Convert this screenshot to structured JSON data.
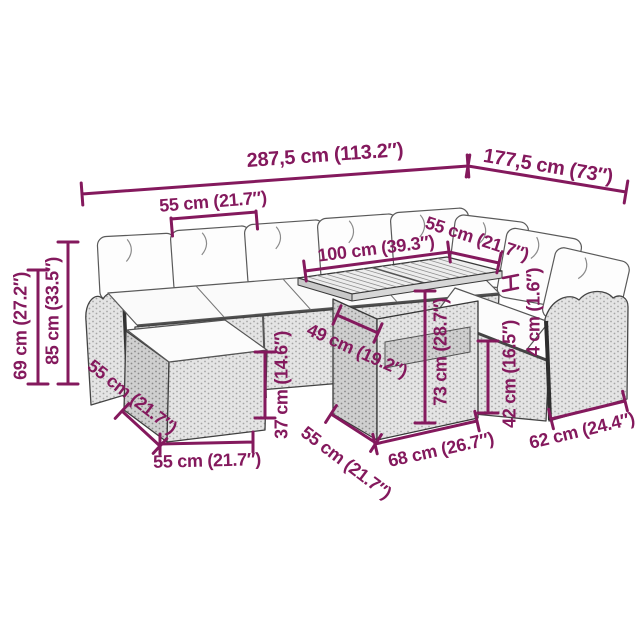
{
  "diagram": {
    "type": "product-dimension-diagram",
    "accent_color": "#84195d",
    "dimensions": [
      {
        "id": "total-width",
        "label": "287,5 cm (113.2″)"
      },
      {
        "id": "right-section-width",
        "label": "177,5 cm (73″)"
      },
      {
        "id": "seat-module-width",
        "label": "55 cm (21.7″)"
      },
      {
        "id": "backrest-height",
        "label": "69 cm (27.2″)"
      },
      {
        "id": "total-height",
        "label": "85 cm (33.5″)"
      },
      {
        "id": "footstool-depth",
        "label": "55 cm (21.7″)"
      },
      {
        "id": "footstool-width",
        "label": "55 cm (21.7″)"
      },
      {
        "id": "footstool-height",
        "label": "37 cm (14.6″)"
      },
      {
        "id": "tabletop-depth",
        "label": "49 cm (19.2″)"
      },
      {
        "id": "tabletop-width",
        "label": "100 cm (39.3″)"
      },
      {
        "id": "right-seat-width",
        "label": "55 cm (21.7″)"
      },
      {
        "id": "cushion-thickness",
        "label": "4 cm (1.6″)"
      },
      {
        "id": "table-height",
        "label": "73 cm (28.7″)"
      },
      {
        "id": "seat-height",
        "label": "42 cm (16.5″)"
      },
      {
        "id": "table-base-width",
        "label": "68 cm (26.7″)"
      },
      {
        "id": "right-seat-depth",
        "label": "62 cm (24.4″)"
      },
      {
        "id": "table-base-depth",
        "label": "55 cm (21.7″)"
      }
    ]
  }
}
